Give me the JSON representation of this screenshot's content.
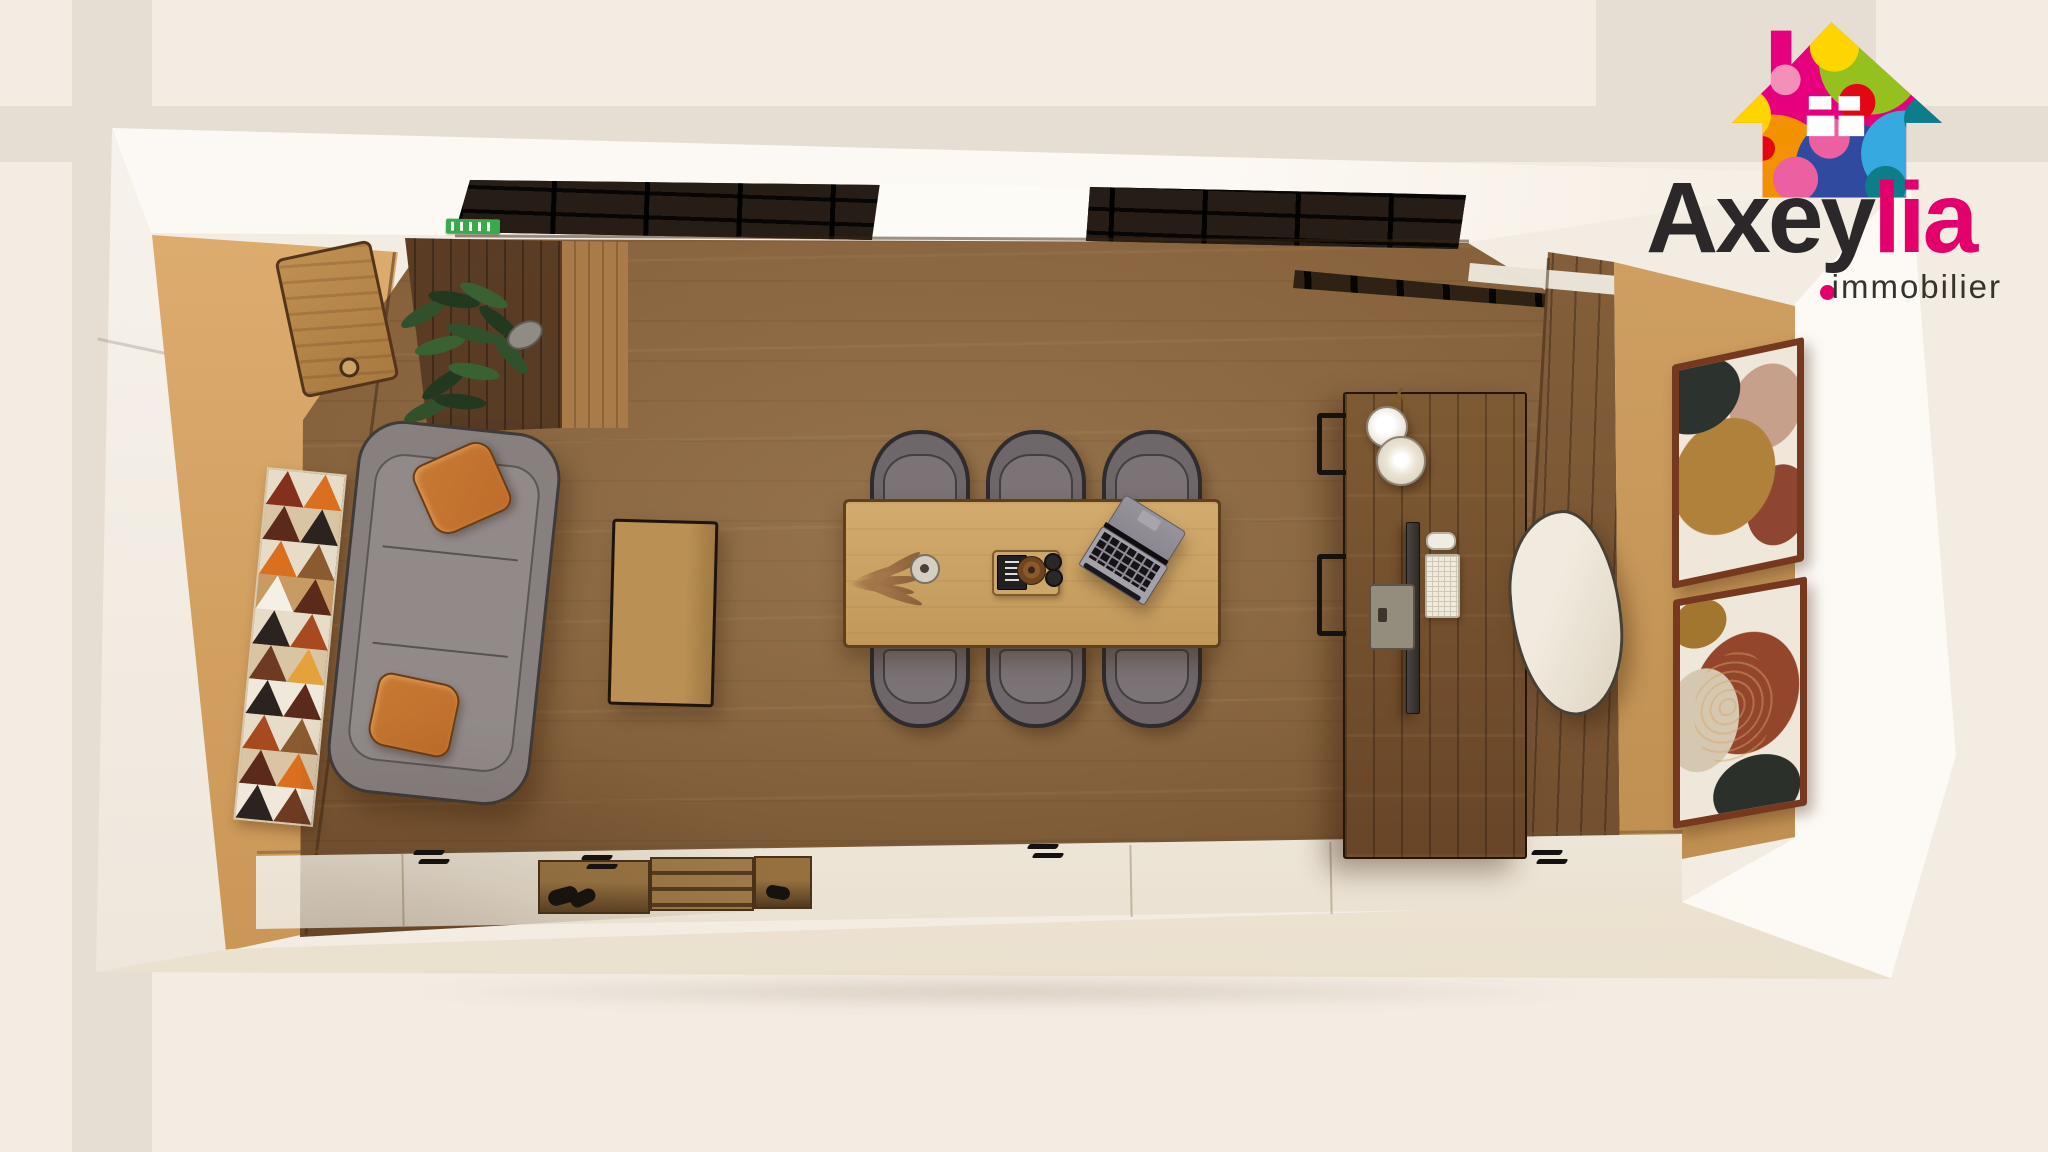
{
  "brand": {
    "name_primary": "Axey",
    "name_accent": "lia",
    "tagline": "immobilier",
    "house_icon": "multicolor-bubble-house",
    "house_colors": [
      "#e6007e",
      "#f39200",
      "#ffd500",
      "#95c11f",
      "#2f4a9e",
      "#36a9e1",
      "#0e7d8a",
      "#e30613",
      "#f48fb8",
      "#ec5fa1"
    ]
  },
  "palette": {
    "bg": "#f3ece3",
    "band": "#e6ded2",
    "wall_white": "#f9f5ef",
    "wall_tan": "#e3b276",
    "wall_tan_dark": "#c59150",
    "wall_tan_right": "#d0a160",
    "floor": "#7f5b36",
    "oak": "#cda76a",
    "desk_wood": "#76532f",
    "wood_panel": "#84603a",
    "glass": "#1d1712",
    "sofa": "#87807f",
    "pillow": "#bf6d2a",
    "chair_shell": "#6e6668",
    "cream_chair": "#eee8db",
    "frame_wood": "#76391f",
    "sideboard": "#f2ecdf",
    "exit_green": "#3aa94b",
    "accent": "#e4006a",
    "logo_text": "#2c2728",
    "tagline": "#38322e"
  },
  "scene": {
    "view": "top-down dollhouse 3D render",
    "room": "office meeting room",
    "elements": [
      "glass partition wall",
      "exit sign",
      "hanging plant",
      "wall cabinet door",
      "geometric triangle wall art",
      "grey sofa with rust cushions",
      "wood coffee table",
      "oak meeting table",
      "six dark shell chairs",
      "dried pampas in vase",
      "serving tray with book, bowl and cups",
      "open laptop",
      "rustic wood desk",
      "two pendant lamps",
      "monitor, keyboard and mouse",
      "cream desk chair",
      "two framed abstract artworks",
      "wood wall panelling",
      "long sideboard with black handles",
      "open wood shelf compartments"
    ]
  }
}
